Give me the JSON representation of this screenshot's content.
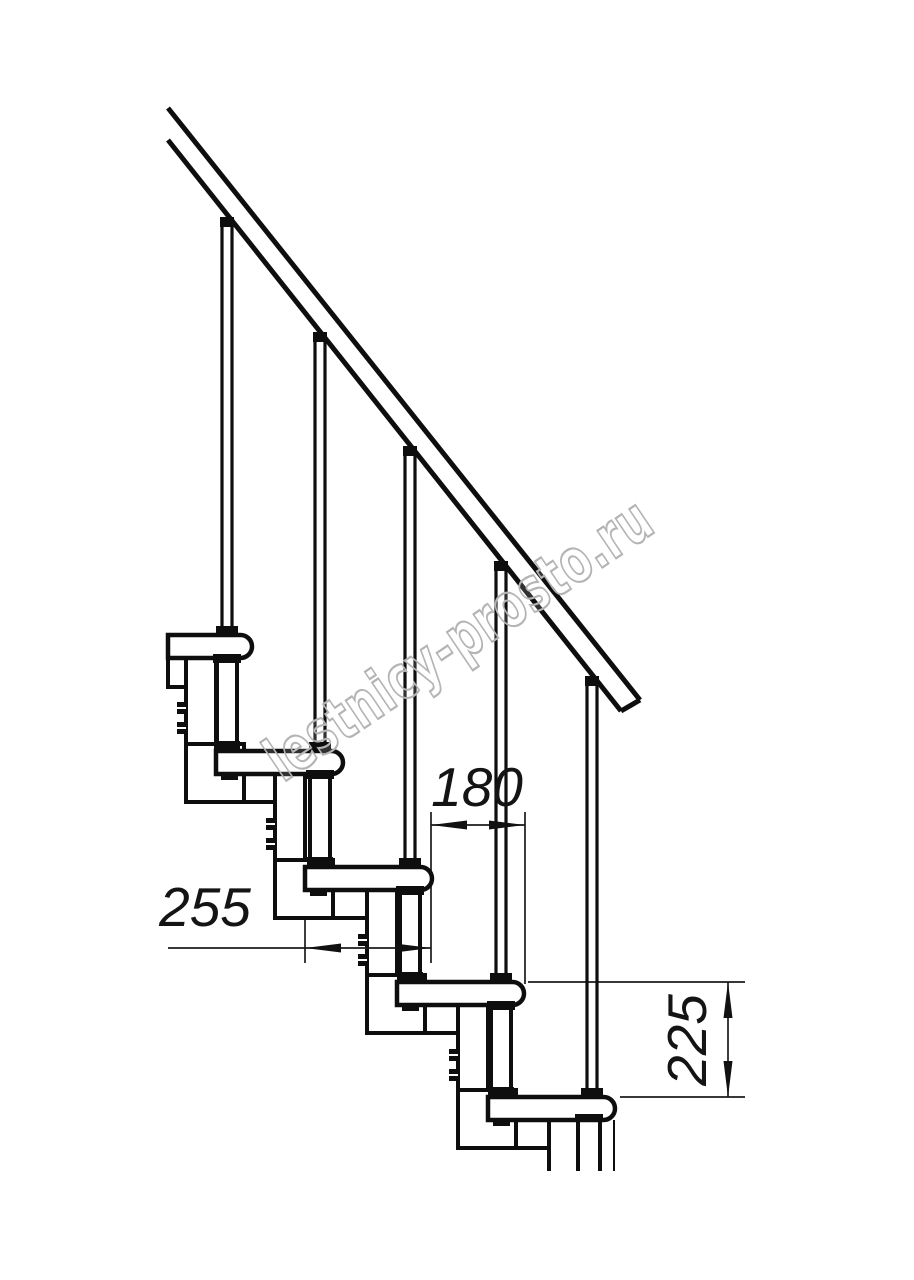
{
  "drawing": {
    "type": "staircase-side-elevation-technical-drawing",
    "watermark": "lestnicy-prosto.ru",
    "dimensions": {
      "tread_depth": "255",
      "step_going": "180",
      "step_rise": "225"
    },
    "colors": {
      "line": "#0e0e0e",
      "dimension": "#1b1b1b",
      "watermark": "#b4b4b4",
      "background": "#ffffff"
    }
  }
}
